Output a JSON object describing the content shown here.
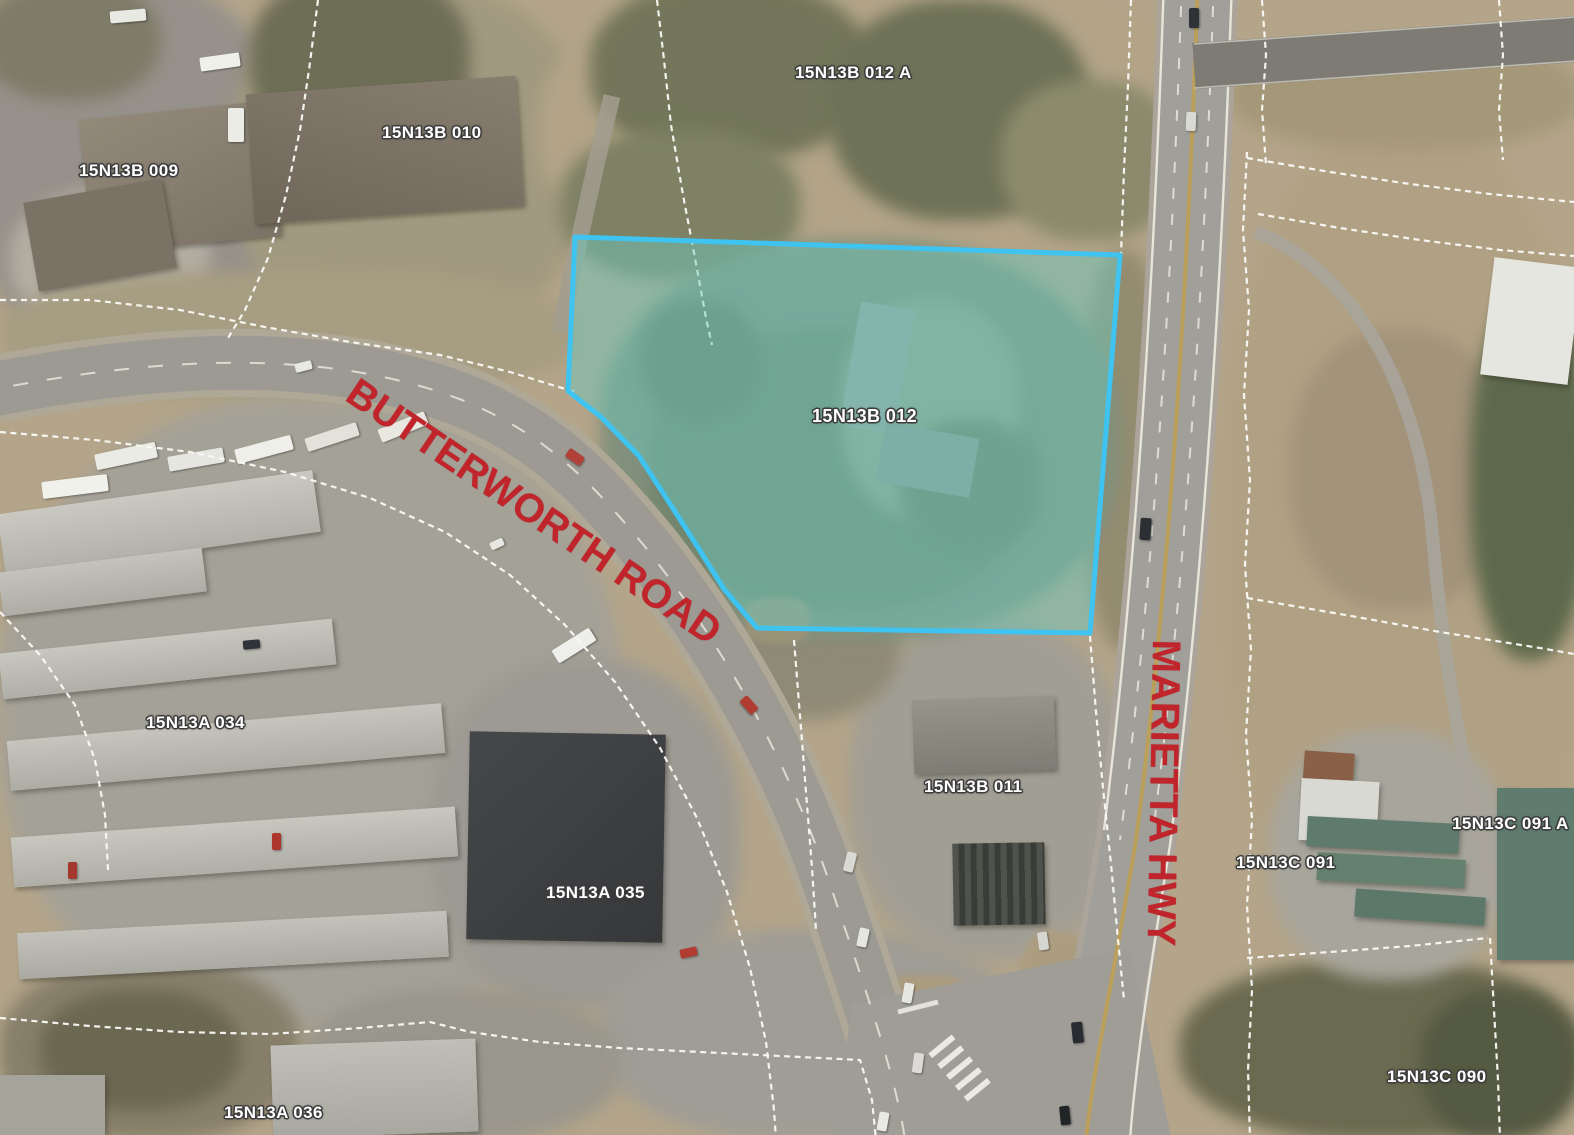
{
  "parcel_labels": [
    {
      "id": "15N13B 012 A"
    },
    {
      "id": "15N13B 010"
    },
    {
      "id": "15N13B 009"
    },
    {
      "id": "15N13B 012"
    },
    {
      "id": "15N13A 034"
    },
    {
      "id": "15N13B 011"
    },
    {
      "id": "15N13C 091 A"
    },
    {
      "id": "15N13C 091"
    },
    {
      "id": "15N13A 035"
    },
    {
      "id": "15N13A 036"
    },
    {
      "id": "15N13C 090"
    }
  ],
  "road_labels": [
    {
      "name": "BUTTERWORTH ROAD"
    },
    {
      "name": "MARIETTA HWY"
    }
  ],
  "highlighted_parcel": {
    "id": "15N13B 012",
    "outline_color": "#3fc3f0",
    "fill_color": "rgba(108,200,188,0.48)"
  },
  "colors": {
    "road_label_red": "#c1252c",
    "parcel_label_text": "#ffffff",
    "parcel_boundary_line": "#fafaf5"
  }
}
